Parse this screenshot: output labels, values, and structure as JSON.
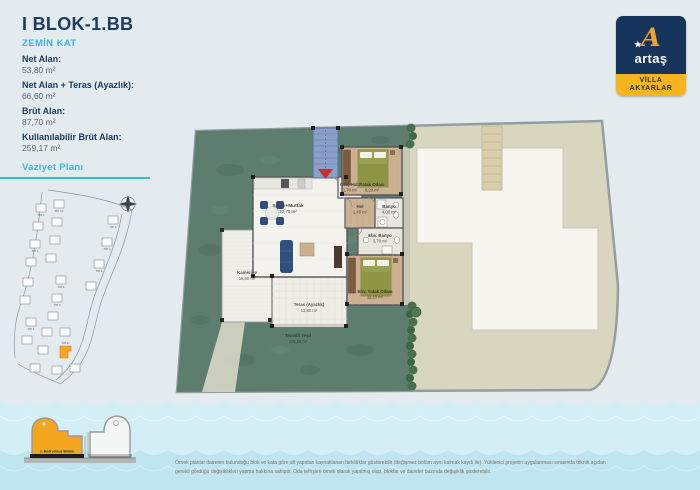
{
  "header": {
    "title": "I BLOK-1.BB",
    "floor": "ZEMİN KAT",
    "areas": [
      {
        "label": "Net Alan:",
        "value": "53,80 m²"
      },
      {
        "label": "Net Alan + Teras (Ayazlık):",
        "value": "66,60 m²"
      },
      {
        "label": "Brüt Alan:",
        "value": "87,70 m²"
      },
      {
        "label": "Kullanılabilir Brüt Alan:",
        "value": "259,17 m²"
      }
    ]
  },
  "logo": {
    "monogram": "A",
    "star": "★",
    "brand": "artaş",
    "project_line1": "VİLLA",
    "project_line2": "AKYARLAR",
    "colors": {
      "navy": "#17355c",
      "gold": "#f0a32b",
      "yellow": "#f6b41f"
    }
  },
  "site_plan": {
    "title": "Vaziyet Planı",
    "highlight_color": "#f5a623",
    "unit_labels": [
      "TİP 7",
      "TİP 10",
      "TİP 2",
      "TİP 1",
      "TİP 4",
      "TİP 6",
      "TİP 5",
      "TİP 3",
      "TİP 1",
      "TİP 9"
    ]
  },
  "floor_plan": {
    "rooms": [
      {
        "id": "salon",
        "name": "Salon+Mutfak",
        "area": "22,70 m²"
      },
      {
        "id": "giris",
        "name": "Giriş Holü",
        "area": "1,70 m²"
      },
      {
        "id": "hol",
        "name": "Hol",
        "area": "1,40 m²"
      },
      {
        "id": "yatak",
        "name": "Yatak Odası",
        "area": "9,20 m²"
      },
      {
        "id": "banyo",
        "name": "Banyo",
        "area": "4,00 m²"
      },
      {
        "id": "ebv-banyo",
        "name": "Ebv. Banyo",
        "area": "3,70 m²"
      },
      {
        "id": "ebv-yatak",
        "name": "Ebv. Yatak Odası",
        "area": "11,10 m²"
      },
      {
        "id": "kameriye",
        "name": "Kameriye",
        "area": "18,60 m²"
      },
      {
        "id": "teras",
        "name": "Teras (Ayazlık)",
        "area": "12,80 m²"
      },
      {
        "id": "yesil",
        "name": "Temsili Yeşil",
        "area": "116,28 m²"
      }
    ]
  },
  "section": {
    "label": "1. Bodrumsuz Bölüm"
  },
  "disclaimer": {
    "line1": "Örnek planlar dairenin bulunduğu blok ve kata göre alt yapıdan kaynaklanan farklılıklar gösterebilir (değişmez bölüm aynı kalmak kaydı ile). Yüklenici projenin uygulanması sırasında teknik açıdan",
    "line2": "gerekli gördüğü değişiklikleri yapma hakkına sahiptir. Oda tefrişleri örnek olarak yapılmış olup, bloklar ve daireler bazında değişiklik gösterebilir."
  }
}
